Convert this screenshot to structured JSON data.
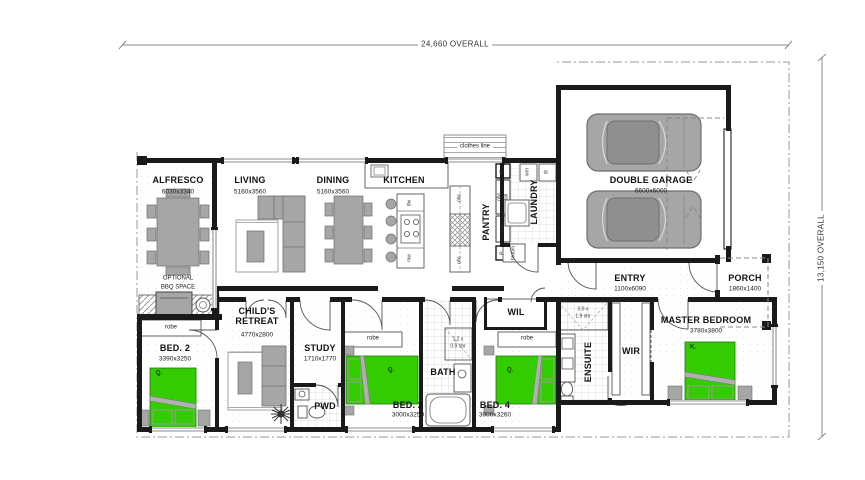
{
  "title": "house-floor-plan",
  "dimensions": {
    "overall_width": "24,660 OVERALL",
    "overall_depth": "13,150 OVERALL"
  },
  "rooms": {
    "alfresco": {
      "name": "ALFRESCO",
      "size": "6030x3340"
    },
    "living": {
      "name": "LIVING",
      "size": "5160x3560"
    },
    "dining": {
      "name": "DINING",
      "size": "5160x3560"
    },
    "kitchen": {
      "name": "KITCHEN"
    },
    "pantry": {
      "name": "PANTRY"
    },
    "laundry": {
      "name": "LAUNDRY"
    },
    "garage": {
      "name": "DOUBLE GARAGE",
      "size": "6600x6000"
    },
    "entry": {
      "name": "ENTRY",
      "size": "1100x6090"
    },
    "porch": {
      "name": "PORCH",
      "size": "1860x1400"
    },
    "childs_retreat": {
      "name": "CHILD'S RETREAT",
      "size": "4770x2800"
    },
    "study": {
      "name": "STUDY",
      "size": "1710x1770"
    },
    "pwd": {
      "name": "PWD"
    },
    "bed2_left": {
      "name": "BED. 2",
      "size": "3390x3250"
    },
    "bed2_mid": {
      "name": "BED. 2",
      "size": "3000x3250"
    },
    "bath": {
      "name": "BATH"
    },
    "bed4": {
      "name": "BED. 4",
      "size": "3000x3260"
    },
    "wil": {
      "name": "WIL"
    },
    "ensuite": {
      "name": "ENSUITE"
    },
    "wir": {
      "name": "WIR"
    },
    "master": {
      "name": "MASTER BEDROOM",
      "size": "3780x3800"
    }
  },
  "labels": {
    "robe": "robe",
    "clothes_line": "clothes line",
    "broom": "broom",
    "ohc": "ohc",
    "tall": "tall",
    "post": "P.",
    "dishwasher": "dw",
    "microwave": "mw",
    "washing_machine": "wm",
    "dryer": "dr",
    "bbq_line1": "OPTIONAL",
    "bbq_line2": "BBQ SPACE",
    "shower_bath_1": "1.2 x",
    "shower_bath_2": "0.9 shr",
    "shower_ens_1": "0.9 x",
    "shower_ens_2": "1.9 shr",
    "queen_bed": "Q.",
    "king_bed": "K."
  },
  "colors": {
    "bed_green": "#33cc00",
    "furniture_gray": "#a6a6a6",
    "wall_black": "#1a1a1a",
    "tile_line": "#cfcfcf",
    "boundary_gray": "#999999"
  }
}
